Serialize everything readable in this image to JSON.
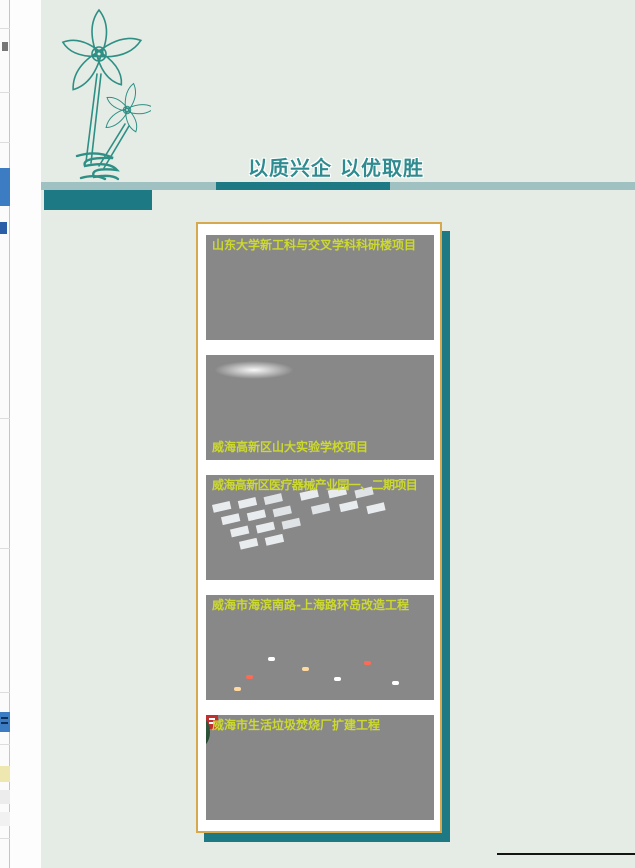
{
  "banner": {
    "slogan": "以质兴企 以优取胜"
  },
  "projects": [
    {
      "caption": "山东大学新工科与交叉学科科研楼项目",
      "caption_position": "top"
    },
    {
      "caption": "威海高新区山大实验学校项目",
      "caption_position": "bottom"
    },
    {
      "caption": "威海高新区医疗器械产业园一、二期项目",
      "caption_position": "top"
    },
    {
      "caption": "威海市海滨南路-上海路环岛改造工程",
      "caption_position": "top"
    },
    {
      "caption": "威海市生活垃圾焚烧厂扩建工程",
      "caption_position": "top"
    }
  ],
  "colors": {
    "page_background": "#e5ece5",
    "accent_teal_dark": "#1d7a85",
    "accent_teal_light": "#9fc1c1",
    "slogan_teal": "#2e8b8f",
    "panel_border_gold": "#d6a94e",
    "caption_yellow_green": "#ccd92f"
  },
  "icons": {
    "flower_line_art": "two outlined flowers with long stems and scribble base"
  }
}
